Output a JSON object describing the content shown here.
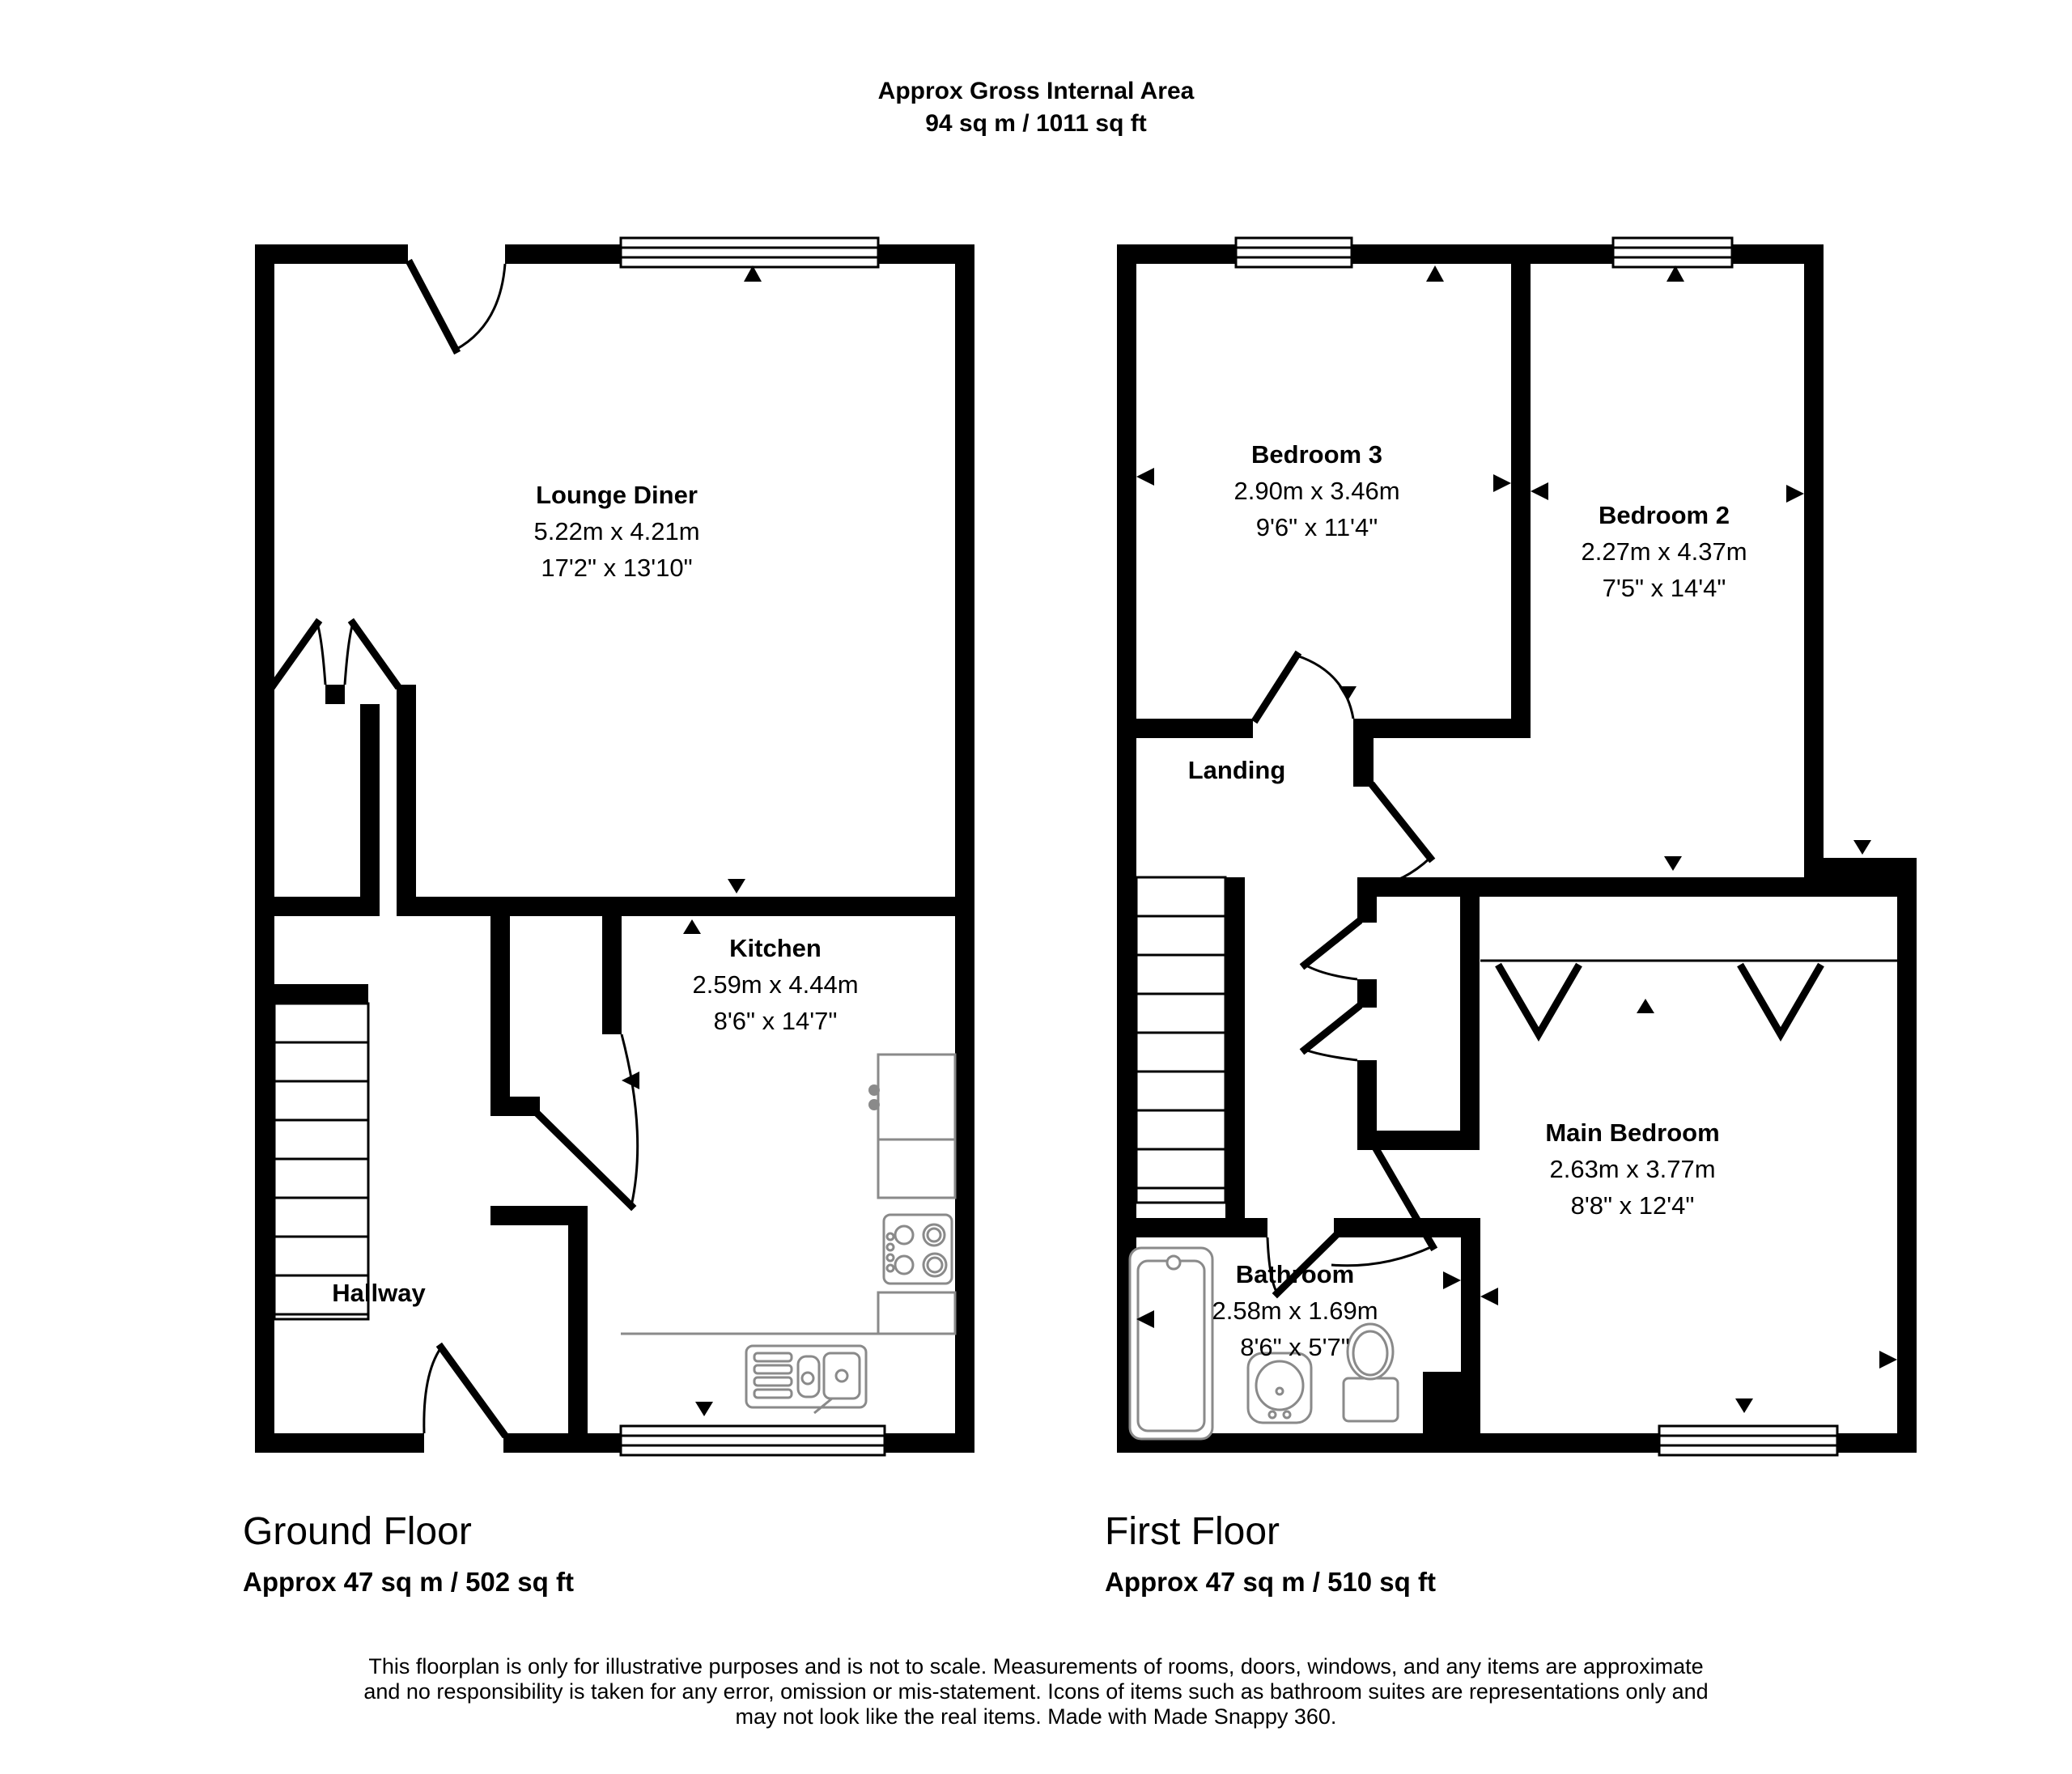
{
  "title": {
    "line1": "Approx Gross Internal Area",
    "line2": "94 sq m / 1011 sq ft"
  },
  "ground_floor": {
    "label": "Ground Floor",
    "area": "Approx 47 sq m / 502 sq ft",
    "rooms": {
      "lounge": {
        "name": "Lounge Diner",
        "metric": "5.22m x 4.21m",
        "imperial": "17'2\" x 13'10\""
      },
      "kitchen": {
        "name": "Kitchen",
        "metric": "2.59m x 4.44m",
        "imperial": "8'6\" x 14'7\""
      },
      "hallway": {
        "name": "Hallway"
      }
    }
  },
  "first_floor": {
    "label": "First Floor",
    "area": "Approx 47 sq m / 510 sq ft",
    "rooms": {
      "bedroom3": {
        "name": "Bedroom 3",
        "metric": "2.90m x 3.46m",
        "imperial": "9'6\" x 11'4\""
      },
      "bedroom2": {
        "name": "Bedroom 2",
        "metric": "2.27m x 4.37m",
        "imperial": "7'5\" x 14'4\""
      },
      "main_bedroom": {
        "name": "Main Bedroom",
        "metric": "2.63m x 3.77m",
        "imperial": "8'8\" x 12'4\""
      },
      "bathroom": {
        "name": "Bathroom",
        "metric": "2.58m x 1.69m",
        "imperial": "8'6\" x 5'7\""
      },
      "landing": {
        "name": "Landing"
      }
    }
  },
  "disclaimer": {
    "line1": "This floorplan is only for illustrative purposes and is not to scale. Measurements of rooms, doors, windows, and any items are approximate",
    "line2": "and no responsibility is taken for any error, omission or mis-statement. Icons of items such as bathroom suites are representations only and",
    "line3": "may not look like the real items. Made with Made Snappy 360."
  },
  "colors": {
    "walls": "#000000",
    "background": "#ffffff",
    "fixtures": "#8a8a8a"
  }
}
